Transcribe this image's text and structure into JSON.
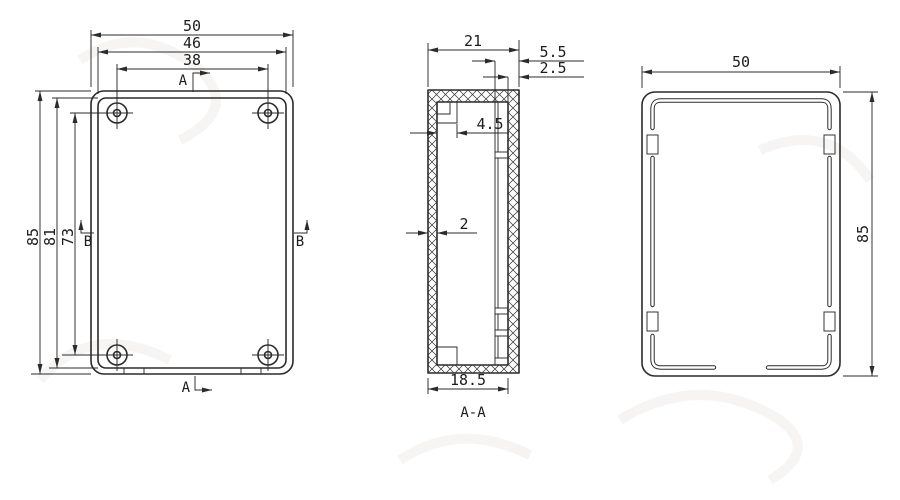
{
  "colors": {
    "line": "#2b2b2b",
    "text": "#1c1c1c",
    "background": "#ffffff"
  },
  "front_view": {
    "dim_outer_width": "50",
    "dim_inner_width": "46",
    "dim_hole_spacing_width": "38",
    "dim_outer_height": "85",
    "dim_inner_height": "81",
    "dim_hole_spacing_height": "73",
    "section_marker_top": "A",
    "section_marker_bottom": "A",
    "section_marker_left": "B",
    "section_marker_right": "B"
  },
  "section_view": {
    "title": "A-A",
    "dim_depth": "21",
    "dim_lip_offset": "5.5",
    "dim_right_wall": "2.5",
    "dim_boss_width": "4.5",
    "dim_front_wall": "2",
    "dim_inner_depth": "18.5"
  },
  "side_view": {
    "dim_width": "50",
    "dim_height": "85"
  }
}
